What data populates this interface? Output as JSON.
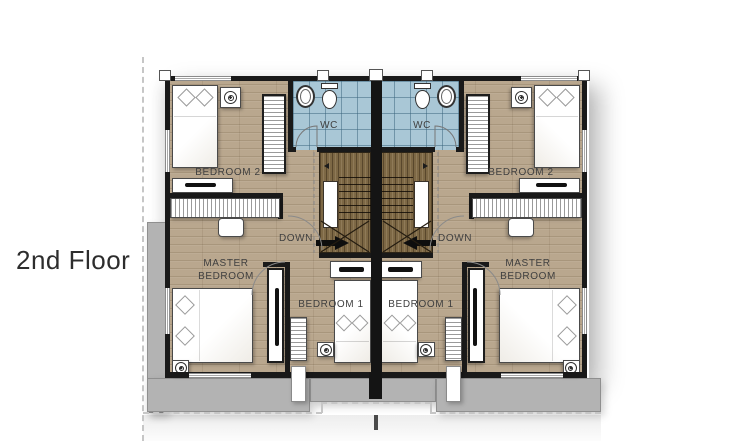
{
  "floor_label": "2nd Floor",
  "units": {
    "left": {
      "bedroom2_label": "BEDROOM 2",
      "wc_label": "WC",
      "down_label": "DOWN",
      "master_label_line1": "MASTER",
      "master_label_line2": "BEDROOM",
      "bedroom1_label": "BEDROOM 1"
    },
    "right": {
      "bedroom2_label": "BEDROOM 2",
      "wc_label": "WC",
      "down_label": "DOWN",
      "master_label_line1": "MASTER",
      "master_label_line2": "BEDROOM",
      "bedroom1_label": "BEDROOM 1"
    }
  },
  "colors": {
    "floor_wood": "#b9a78e",
    "stair_wood": "#7d6845",
    "wc_tile": "#a9c7d6",
    "wall": "#191919",
    "terrace_gray": "#b3b3b3"
  }
}
